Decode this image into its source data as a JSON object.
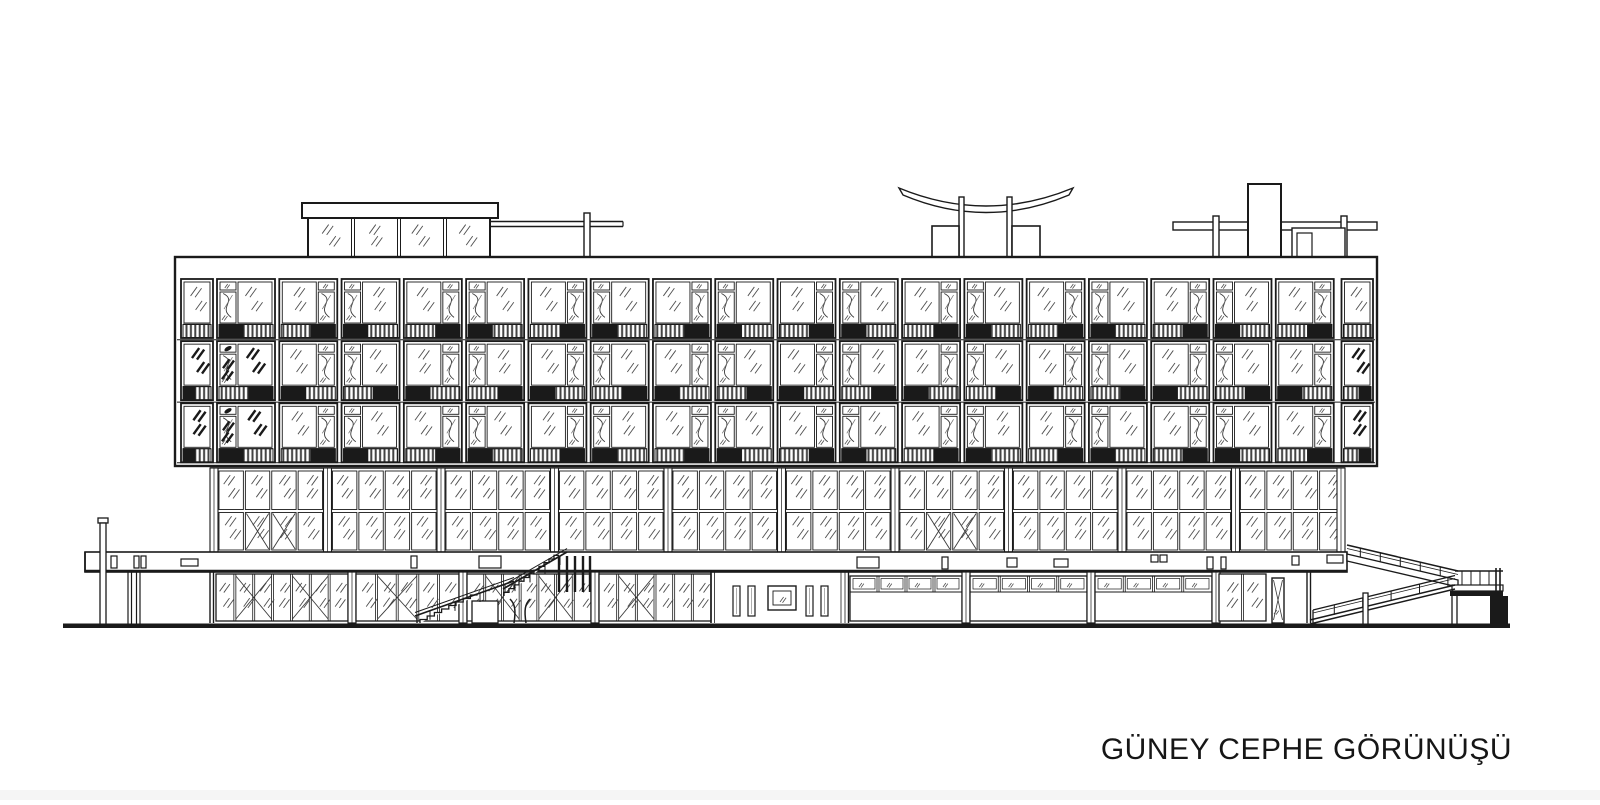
{
  "title": {
    "text": "GÜNEY CEPHE GÖRÜNÜŞÜ"
  },
  "drawing": {
    "paper": "#ffffff",
    "ink": "#1a1a1a",
    "hatch_ink": "#4f4f4f",
    "edge_strip": "#f5f5f5",
    "floors": 3,
    "modules_per_floor": 18,
    "end_modules_per_floor": 2,
    "mezzanine_sections": 10,
    "mezzanine_panes_per_section": 4,
    "mezzanine_x_sections": [
      0,
      6
    ],
    "ground_glass_sections": 4,
    "ground_transom_sections": 3,
    "roof_elements": [
      "penthouse",
      "guard-rail",
      "curved-canopy",
      "service-tower"
    ],
    "circulation": [
      "exterior-stair",
      "switchback-ramp"
    ]
  }
}
